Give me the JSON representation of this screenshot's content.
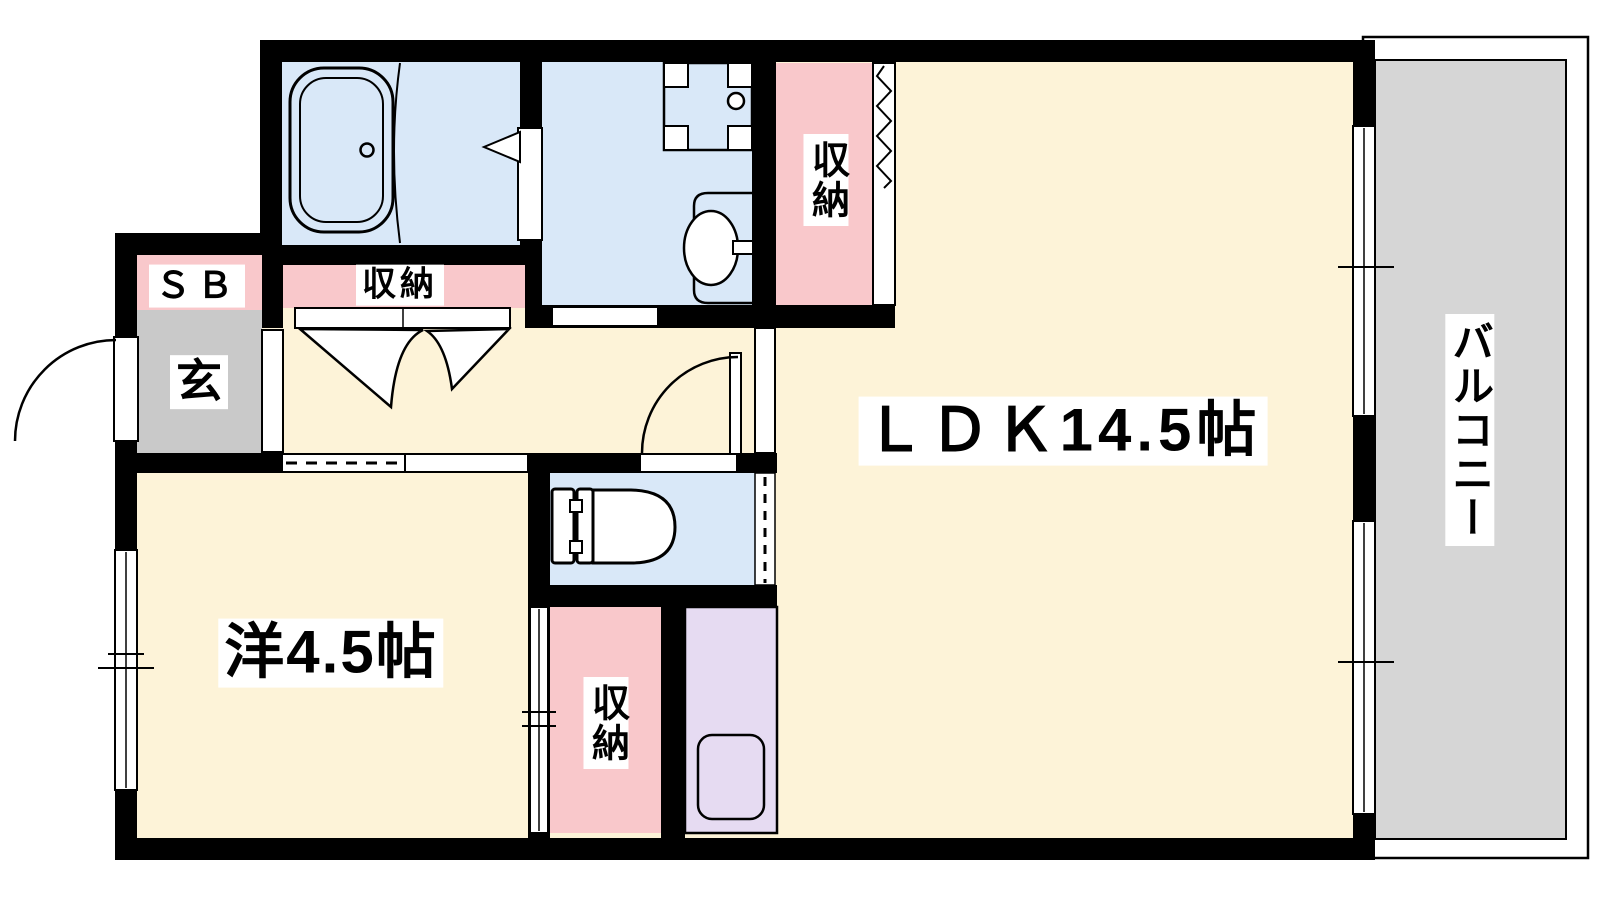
{
  "page": {
    "background": "#ffffff"
  },
  "floorplan": {
    "type": "apartment-floor-plan",
    "labels": {
      "ldk": "ＬＤＫ14.5帖",
      "western_room": "洋4.5帖",
      "balcony": "バルコニー",
      "storage_upper": "収納",
      "storage_hall": "収納",
      "storage_lower": "収納",
      "shoe_box": "ＳＢ",
      "entrance": "玄"
    },
    "colors": {
      "floor_cream": "#fdf3d8",
      "wet_area_blue": "#d9e8f8",
      "storage_pink": "#f9c8cb",
      "entrance_gray": "#c9c9c9",
      "balcony_gray": "#d6d6d6",
      "kitchen_purple": "#e6dbf2",
      "wall_black": "#000000"
    },
    "fixtures": [
      "bathtub",
      "washbasin",
      "washing-machine-pan",
      "toilet",
      "kitchen-sink"
    ],
    "openings": [
      "entrance-swing-door",
      "bathroom-folding-door",
      "closet-bifold-doors",
      "accordion-door",
      "sliding-door",
      "ldk-swing-door",
      "toilet-door",
      "sliding-windows"
    ]
  }
}
